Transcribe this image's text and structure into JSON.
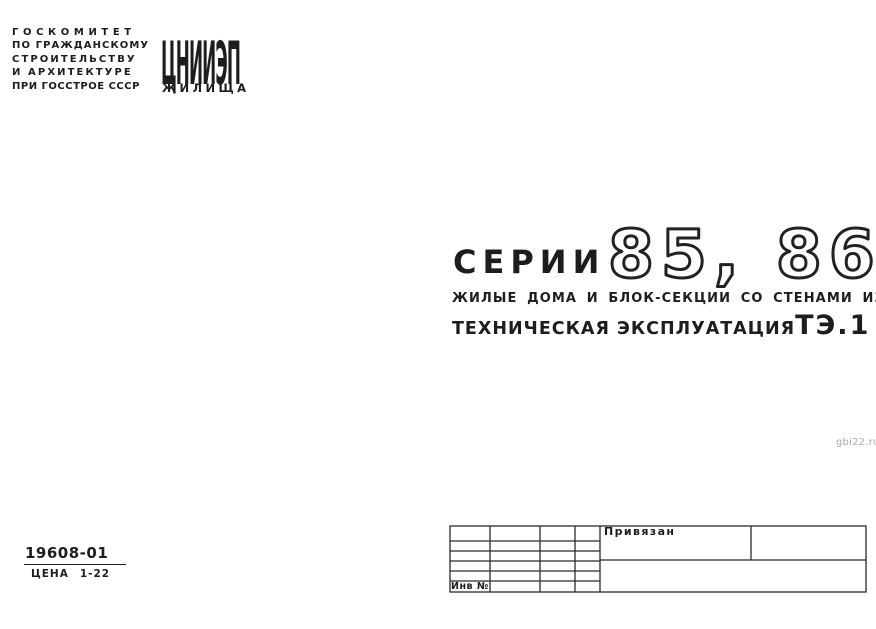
{
  "document": {
    "org": {
      "lines": [
        "ГОСКОМИТЕТ",
        "ПО ГРАЖДАНСКОМУ",
        "СТРОИТЕЛЬСТВУ",
        "И АРХИТЕКТУРЕ",
        "ПРИ ГОССТРОЕ СССР"
      ]
    },
    "logo": {
      "acronym": "ЦНИИЭП",
      "name": "ЖИЛИЩА"
    },
    "title": {
      "series_label": "СЕРИИ",
      "series_numbers": "85, 86",
      "subtitle": "ЖИЛЫЕ ДОМА И БЛОК-СЕКЦИИ СО СТЕНАМИ ИЗ КИРПИЧА",
      "doc_type": "ТЕХНИЧЕСКАЯ ЭКСПЛУАТАЦИЯ",
      "doc_code": "ТЭ.1"
    },
    "catalog": {
      "number": "19608-01",
      "price_label": "ЦЕНА",
      "price_value": "1-22"
    },
    "stamp": {
      "note": "Привязан",
      "inventory_label": "Инв №"
    },
    "watermark": "gbi22.ru"
  },
  "colors": {
    "ink": "#1d1d1d",
    "paper": "#ffffff",
    "watermark_gray": "#a8a8a8"
  }
}
